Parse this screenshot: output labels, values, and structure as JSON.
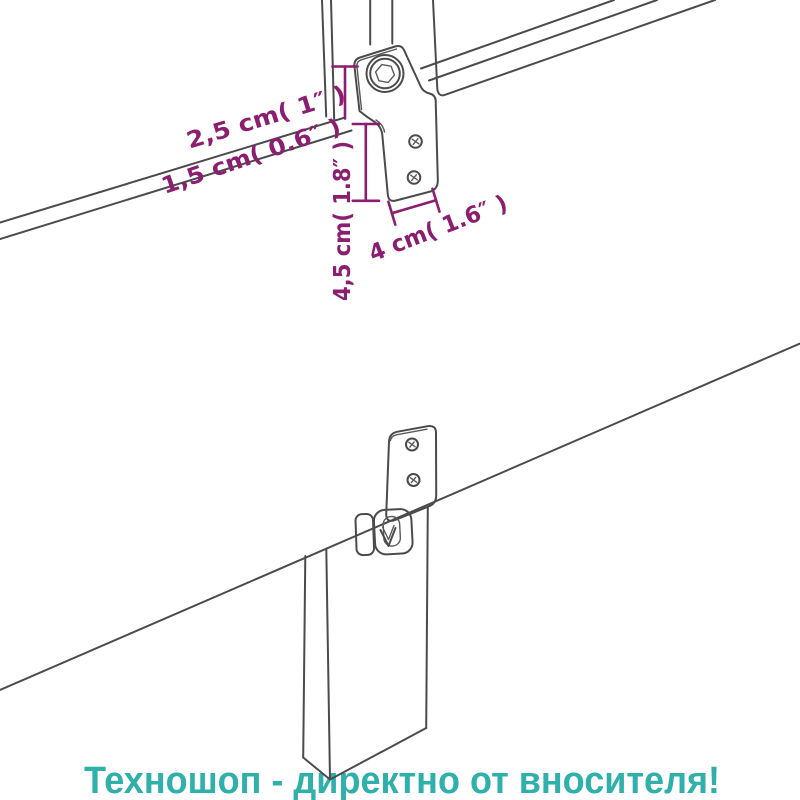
{
  "page": {
    "background_color": "#ffffff"
  },
  "diagram": {
    "line_color": "#4b4b4b",
    "dimension_color": "#8b1e70",
    "labels": {
      "bolt_offset": "2,5 cm( 1″ )",
      "panel_thickness": "1,5 cm( 0.6″ )",
      "bracket_drop": "4,5 cm( 1.8″ )",
      "bracket_width": "4 cm( 1.6″ )"
    }
  },
  "watermark": {
    "text": "Техношоп - директно от вносителя!",
    "color": "#2fb0aa"
  }
}
